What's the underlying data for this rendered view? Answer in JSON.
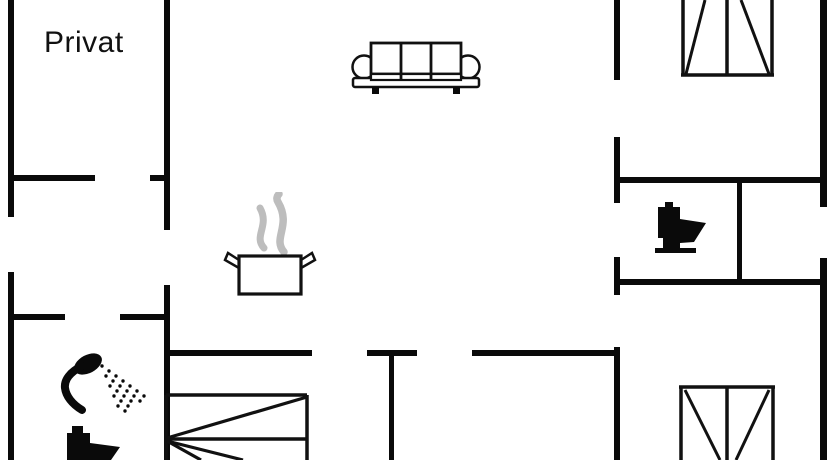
{
  "plan": {
    "type": "holiday-home-floor-plan",
    "labels": {
      "room_private": "Privat"
    },
    "colors": {
      "background": "#ffffff",
      "wall": "#0a0a0a",
      "furniture_line": "#111111",
      "steam": "#bdbdbd"
    },
    "icons": [
      "sofa-icon",
      "cooking-pot-icon",
      "steam-icon",
      "wardrobe-icon-top-right",
      "wardrobe-icon-bottom-right",
      "toilet-icon-right",
      "toilet-icon-bottom-left",
      "shower-icon",
      "bunk-bed-icon"
    ]
  }
}
